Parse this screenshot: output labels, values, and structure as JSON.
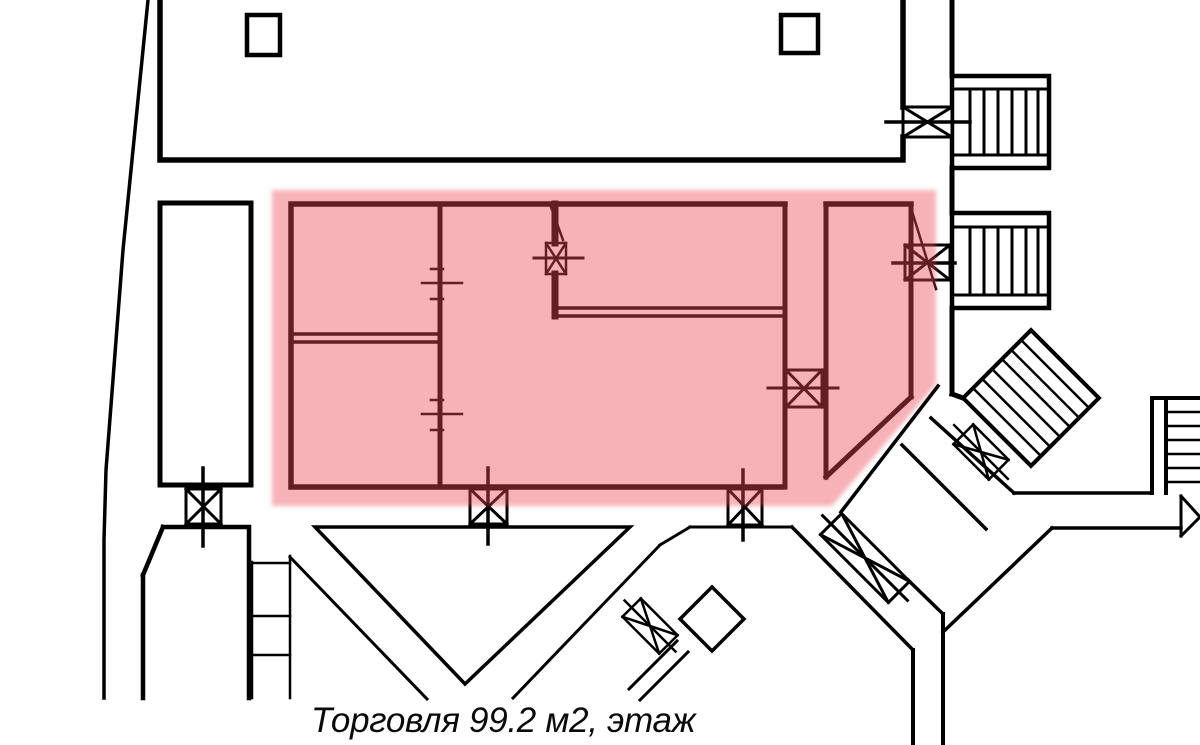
{
  "caption": {
    "text": "Торговля 99.2 м2, этаж"
  },
  "unit": {
    "type": "Торговля",
    "area_label": "99.2 м2",
    "floor_label": "этаж",
    "highlighted": true
  },
  "colors": {
    "wall": "#000000",
    "highlight": "#eb4b55",
    "highlight_tint": "#f7b2b6",
    "background": "#ffffff"
  }
}
